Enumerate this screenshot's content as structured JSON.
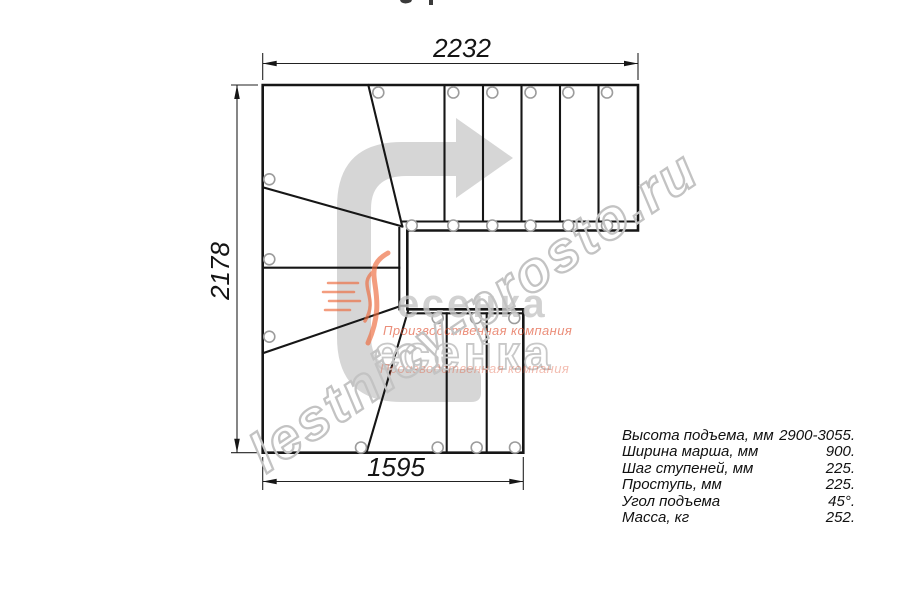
{
  "drawing": {
    "dimensions": {
      "top": "2232",
      "left": "2178",
      "bottom": "1595"
    }
  },
  "specs": {
    "rows": [
      {
        "label": "Высота подъема, мм",
        "value": "2900-3055."
      },
      {
        "label": "Ширина марша, мм",
        "value": "900."
      },
      {
        "label": "Шаг ступеней, мм",
        "value": "225."
      },
      {
        "label": "Проступь, мм",
        "value": "225."
      },
      {
        "label": "Угол подъема",
        "value": "45°."
      },
      {
        "label": "Масса, кг",
        "value": "252."
      }
    ]
  },
  "watermark": {
    "site": "lestnicy-prosto.ru",
    "brand": "есенка",
    "tagline": "Производственная компания"
  },
  "colors": {
    "line": "#161616",
    "arrow_gray": "#d6d6d6",
    "hole_stroke": "#9c9c9c",
    "watermark_stroke": "#c3c3c3",
    "logo_gray": "#c6c6c6",
    "logo_orange": "#de4928",
    "dim_text": "#141414"
  }
}
